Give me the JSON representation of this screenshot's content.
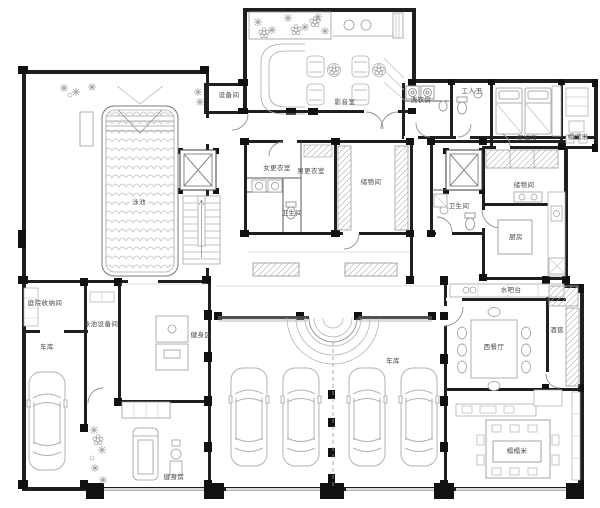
{
  "colors": {
    "wall": "#1f1f1f",
    "line": "#9c9c9c",
    "label": "#474747"
  },
  "rooms": {
    "theater": "影音室",
    "equipment_room": "设备间",
    "laundry": "洗衣房",
    "staff_toilet": "工人卫",
    "nanny_room": "保姆房",
    "tatami_nook": "榻榻米",
    "pool": "泳池",
    "women_changing": "女更衣室",
    "men_changing": "男更衣室",
    "bathroom_center": "卫生间",
    "storage_center": "储物间",
    "bathroom_right": "卫生间",
    "storage_right": "储物间",
    "kitchen": "厨房",
    "water_bar": "水吧台",
    "western_dining": "西餐厅",
    "wine_cellar": "酒窖",
    "tatami_room": "榻榻米",
    "yard_storage": "庭院收纳间",
    "garage_left": "车库",
    "pool_equipment": "泳池设备间",
    "gym_zone": "健身区",
    "gym_room": "健身房",
    "garage_main": "车库"
  }
}
